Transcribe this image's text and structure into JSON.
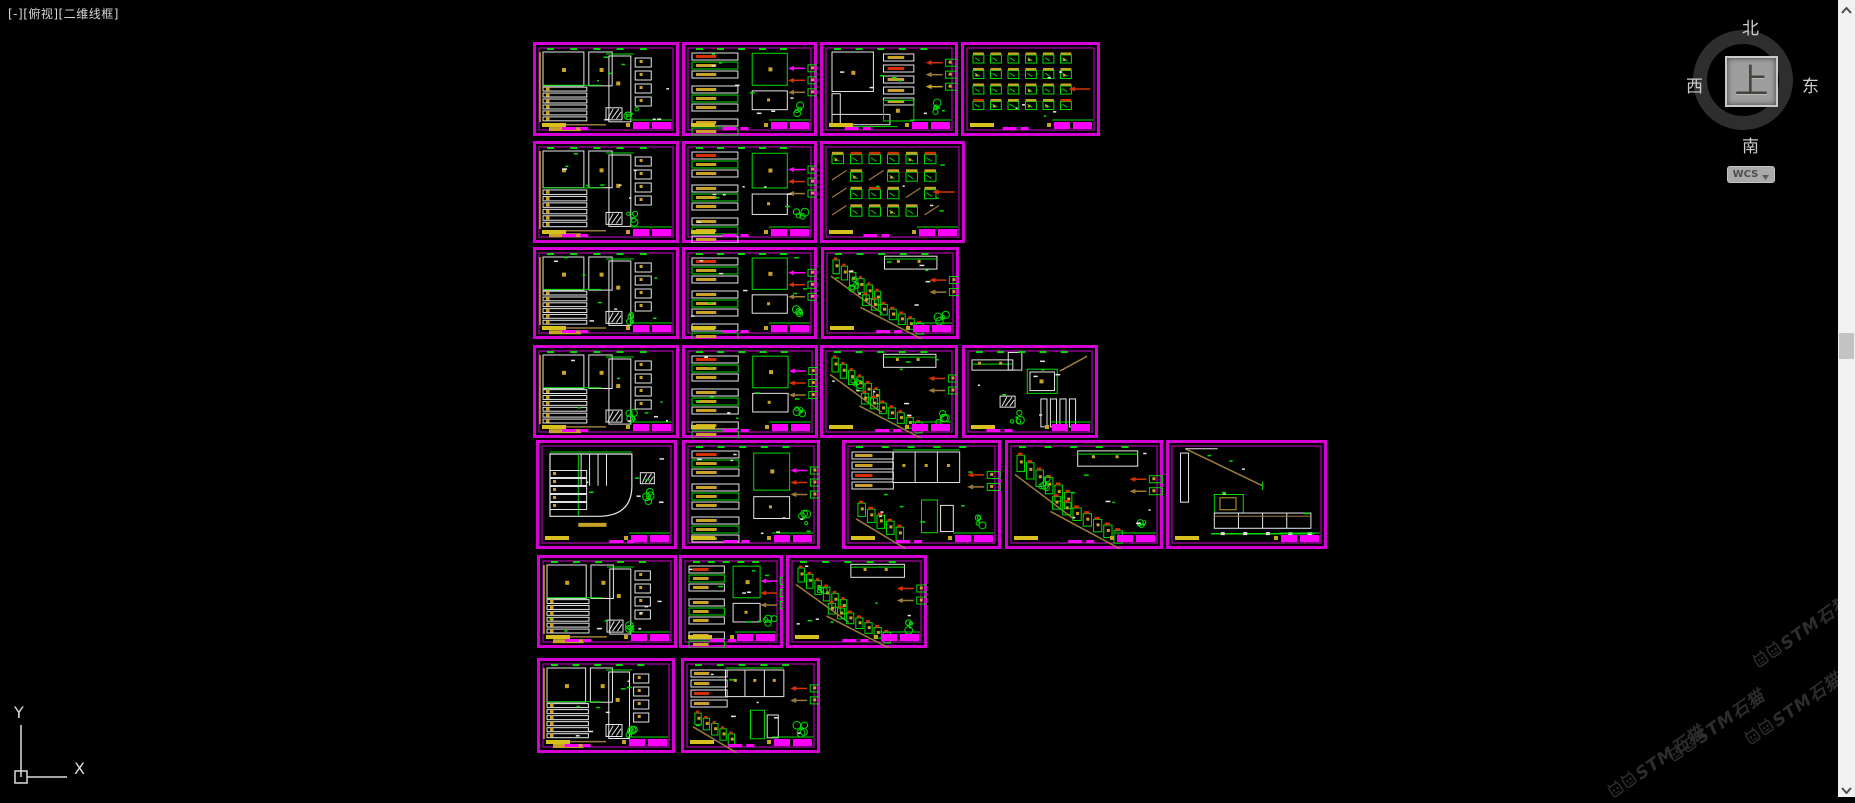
{
  "viewport": {
    "label": "[-][俯视][二维线框]"
  },
  "viewcube": {
    "north": "北",
    "south": "南",
    "east": "东",
    "west": "西",
    "up": "上",
    "wcs": "WCS"
  },
  "ucs": {
    "x_label": "X",
    "y_label": "Y"
  },
  "watermark": {
    "text": "STM石猫",
    "instances": [
      {
        "x": 1745,
        "y": 618,
        "clip": true
      },
      {
        "x": 1660,
        "y": 712
      },
      {
        "x": 1737,
        "y": 695
      },
      {
        "x": 1600,
        "y": 748
      }
    ]
  },
  "palette": {
    "background": "#000000",
    "frame_border": "#d400d4",
    "magenta": "#ff00ff",
    "bright_green": "#00dd00",
    "green": "#00a800",
    "white": "#e6e6e6",
    "gold": "#c9a227",
    "yellow": "#d8c020",
    "tan": "#9b7b3c",
    "red": "#d43000",
    "cyan": "#00c8c8",
    "viewcube_ring": "#2e2e2e",
    "viewcube_face": "#9e9e9e",
    "scroll_track": "#f1f1f1",
    "scroll_thumb": "#c3c3c3",
    "watermark": "#2d2d2d"
  },
  "canvas": {
    "width": 1855,
    "height": 797
  },
  "frames": [
    {
      "id": "sheet-1",
      "x": 533,
      "y": 42,
      "w": 146,
      "h": 94,
      "type": "elevA"
    },
    {
      "id": "sheet-2",
      "x": 682,
      "y": 42,
      "w": 135,
      "h": 94,
      "type": "detailB"
    },
    {
      "id": "sheet-3",
      "x": 820,
      "y": 42,
      "w": 138,
      "h": 94,
      "type": "cornerC"
    },
    {
      "id": "sheet-4",
      "x": 961,
      "y": 42,
      "w": 139,
      "h": 94,
      "type": "symbols"
    },
    {
      "id": "sheet-5",
      "x": 533,
      "y": 141,
      "w": 146,
      "h": 102,
      "type": "elevA"
    },
    {
      "id": "sheet-6",
      "x": 682,
      "y": 141,
      "w": 135,
      "h": 102,
      "type": "detailB"
    },
    {
      "id": "sheet-7",
      "x": 820,
      "y": 141,
      "w": 145,
      "h": 102,
      "type": "symbols"
    },
    {
      "id": "sheet-8",
      "x": 533,
      "y": 247,
      "w": 146,
      "h": 92,
      "type": "elevA"
    },
    {
      "id": "sheet-9",
      "x": 682,
      "y": 247,
      "w": 135,
      "h": 92,
      "type": "detailB"
    },
    {
      "id": "sheet-10",
      "x": 821,
      "y": 247,
      "w": 138,
      "h": 92,
      "type": "stairs"
    },
    {
      "id": "sheet-11",
      "x": 533,
      "y": 345,
      "w": 146,
      "h": 93,
      "type": "elevA"
    },
    {
      "id": "sheet-12",
      "x": 682,
      "y": 345,
      "w": 136,
      "h": 93,
      "type": "detailB"
    },
    {
      "id": "sheet-13",
      "x": 820,
      "y": 345,
      "w": 138,
      "h": 93,
      "type": "stairs"
    },
    {
      "id": "sheet-14",
      "x": 962,
      "y": 345,
      "w": 136,
      "h": 93,
      "type": "lcounter"
    },
    {
      "id": "sheet-15",
      "x": 536,
      "y": 440,
      "w": 141,
      "h": 109,
      "type": "planR"
    },
    {
      "id": "sheet-16",
      "x": 682,
      "y": 440,
      "w": 138,
      "h": 109,
      "type": "detailB"
    },
    {
      "id": "sheet-17",
      "x": 842,
      "y": 440,
      "w": 159,
      "h": 109,
      "type": "mixed"
    },
    {
      "id": "sheet-18",
      "x": 1005,
      "y": 440,
      "w": 158,
      "h": 109,
      "type": "stairs"
    },
    {
      "id": "sheet-19",
      "x": 1166,
      "y": 440,
      "w": 161,
      "h": 109,
      "type": "triangleD"
    },
    {
      "id": "sheet-20",
      "x": 537,
      "y": 555,
      "w": 140,
      "h": 93,
      "type": "elevA"
    },
    {
      "id": "sheet-21",
      "x": 679,
      "y": 555,
      "w": 104,
      "h": 93,
      "type": "detailB"
    },
    {
      "id": "sheet-22",
      "x": 786,
      "y": 555,
      "w": 141,
      "h": 93,
      "type": "stairs"
    },
    {
      "id": "sheet-23",
      "x": 537,
      "y": 658,
      "w": 138,
      "h": 95,
      "type": "elevA"
    },
    {
      "id": "sheet-24",
      "x": 681,
      "y": 658,
      "w": 139,
      "h": 95,
      "type": "mixed"
    }
  ]
}
